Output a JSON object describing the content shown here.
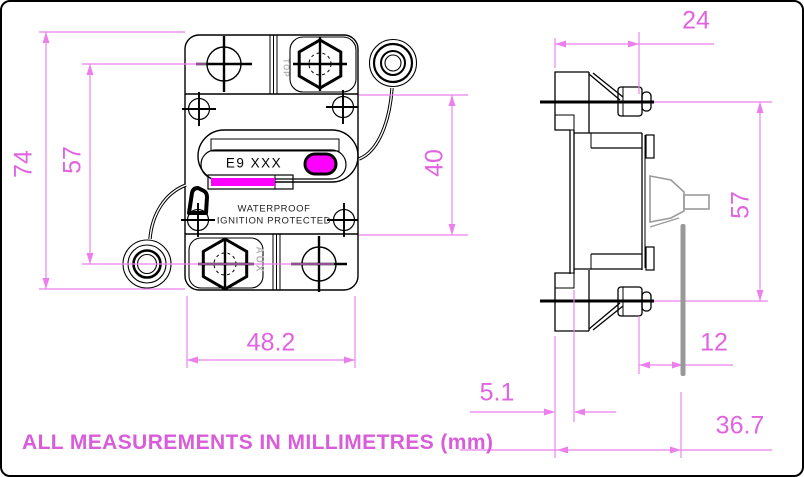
{
  "title_note": "ALL MEASUREMENTS IN MILLIMETRES (mm)",
  "unit": "mm",
  "device": {
    "label": "E9 XXX",
    "marking_line1": "WATERPROOF",
    "marking_line2": "IGNITION PROTECTED",
    "orientation_marking": "TOP",
    "aux_marking": "AUX"
  },
  "dimensions": {
    "front": [
      {
        "id": "overall-height",
        "value": "74"
      },
      {
        "id": "mounting-hole-spacing",
        "value": "57"
      },
      {
        "id": "body-plate-height",
        "value": "40"
      },
      {
        "id": "overall-width",
        "value": "48.2"
      }
    ],
    "side": [
      {
        "id": "top-depth-to-stud",
        "value": "24"
      },
      {
        "id": "stud-centre-spacing",
        "value": "57"
      },
      {
        "id": "stud-past-panel",
        "value": "12"
      },
      {
        "id": "flange-thickness",
        "value": "5.1"
      },
      {
        "id": "depth-behind-flange",
        "value": "36.7"
      }
    ]
  },
  "colors": {
    "dimension_line": "#ec7fec",
    "dimension_text": "#e063e0",
    "note_text": "#d95cd9",
    "highlight_fill": "#ff00ff",
    "line_art": "#000000",
    "muted_gray": "#a6a6a6"
  }
}
